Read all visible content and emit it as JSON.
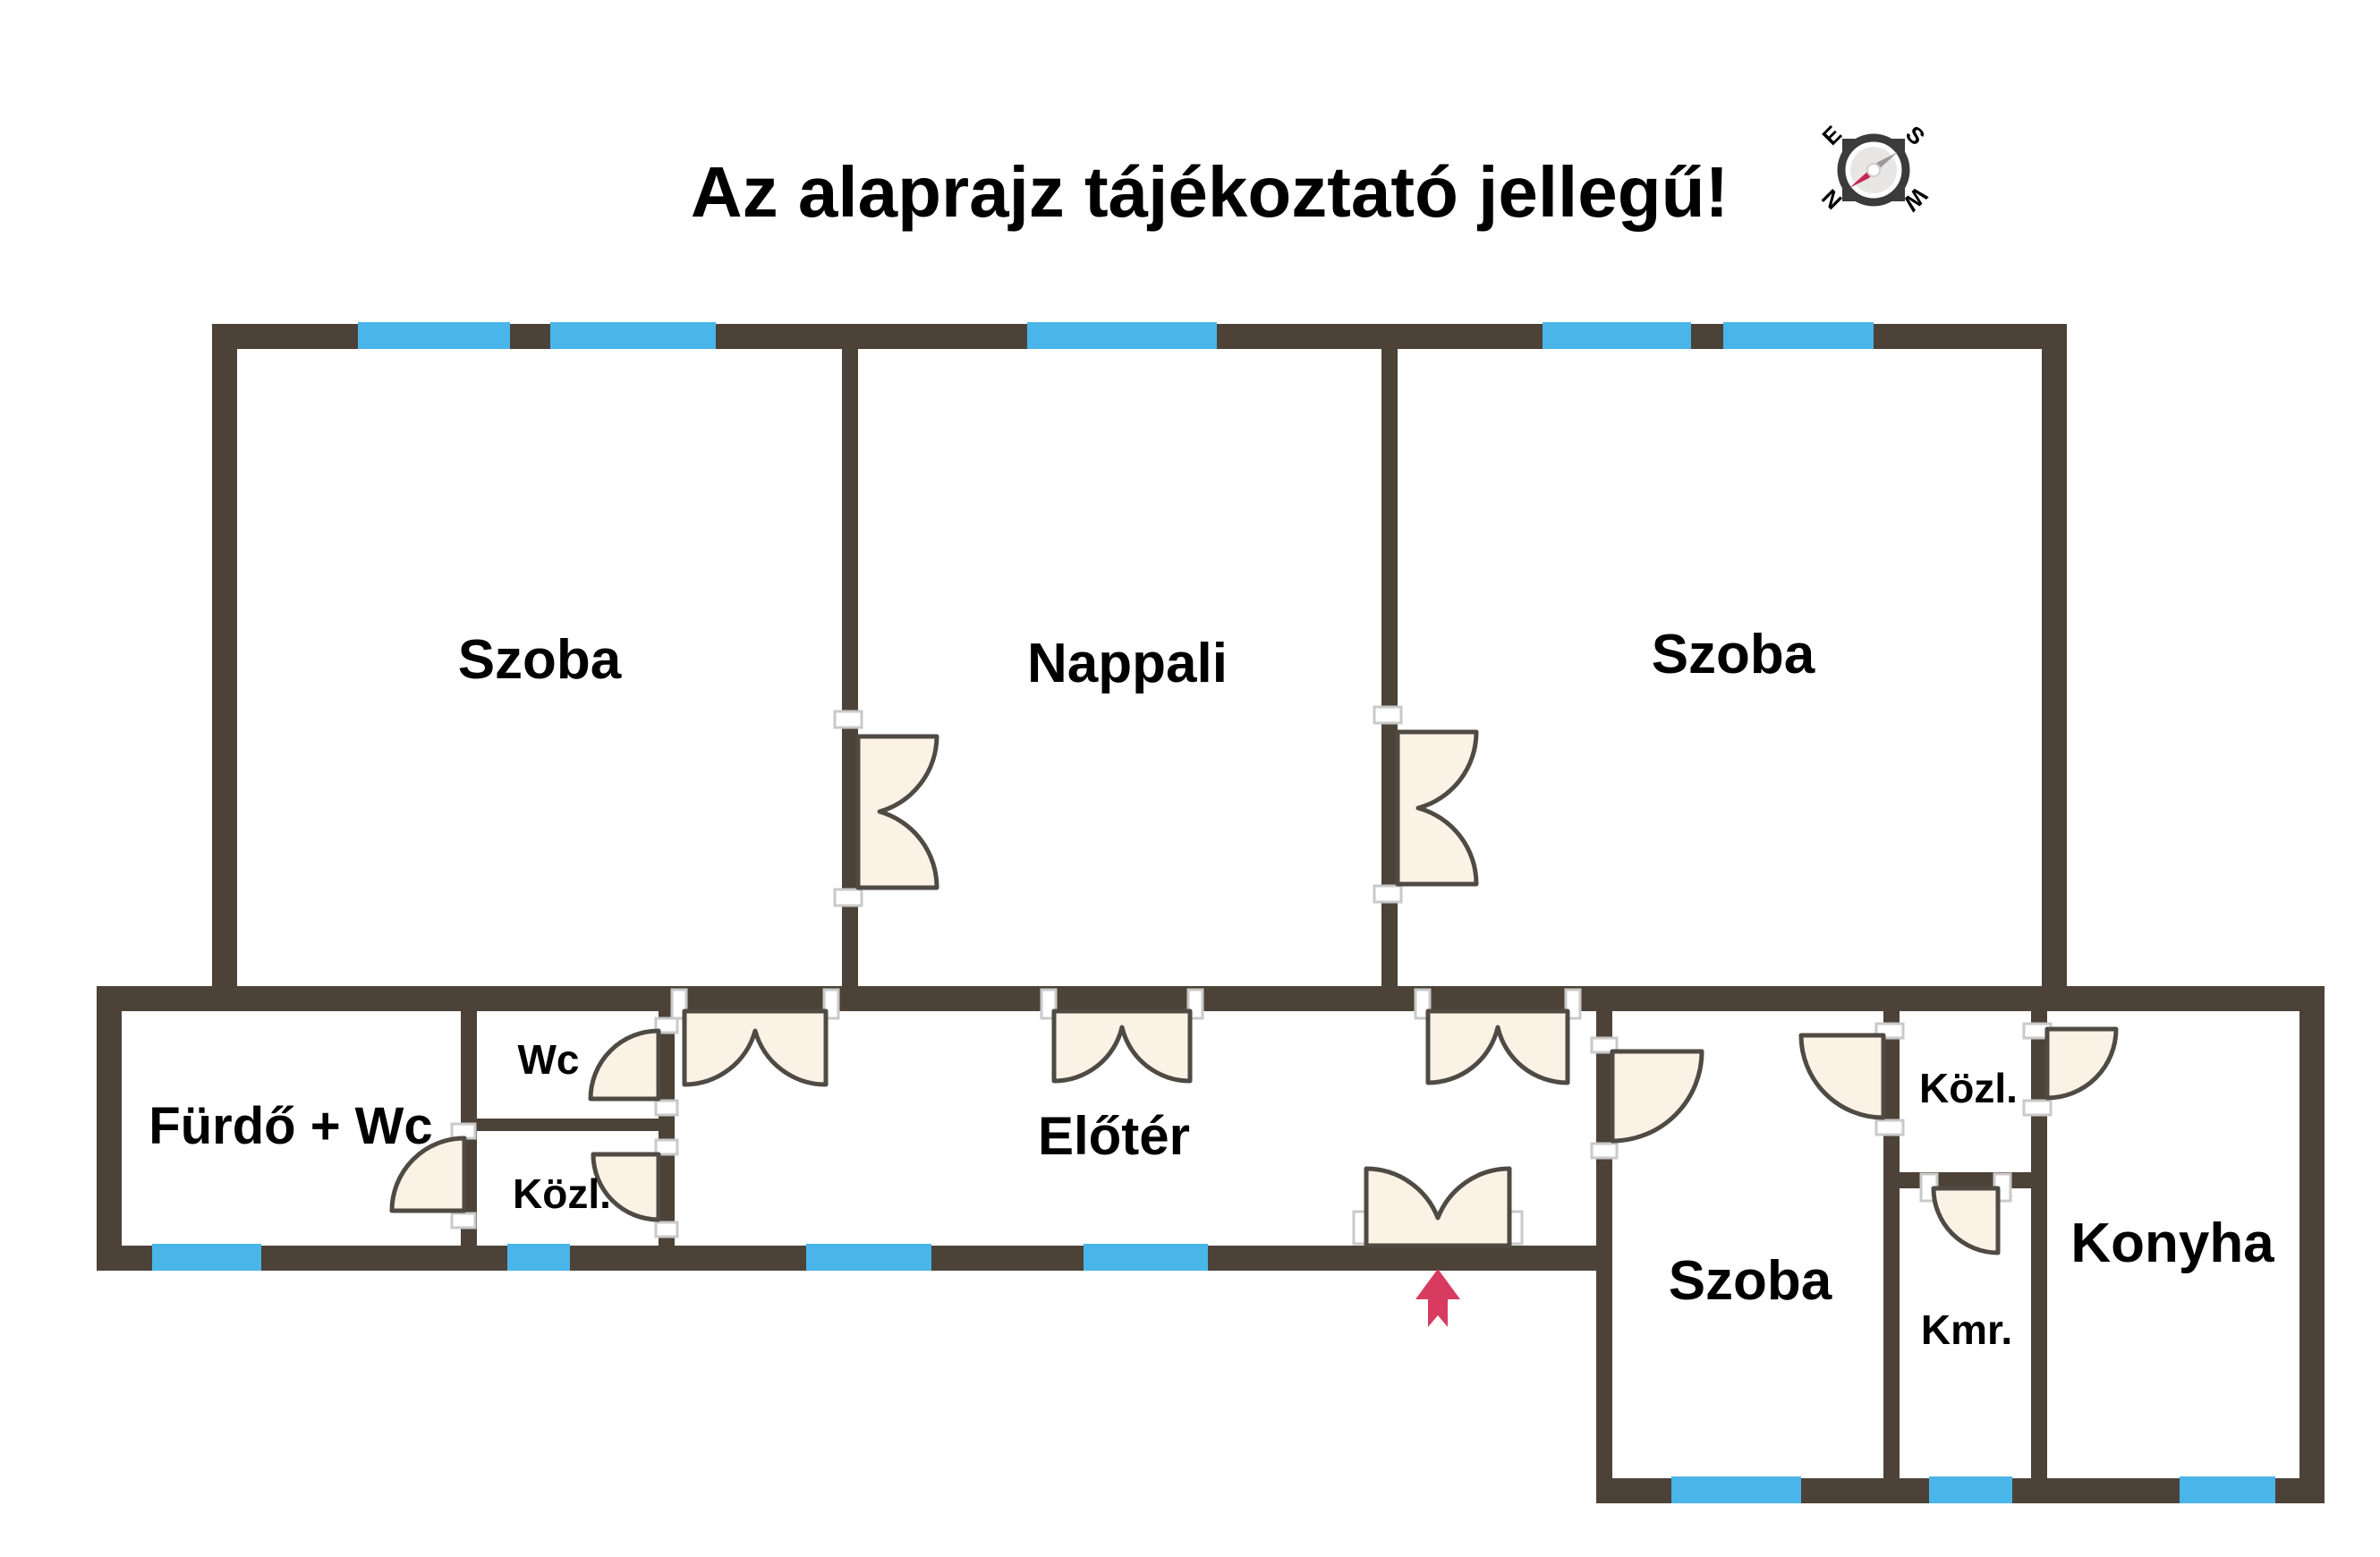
{
  "title": "Az alaprajz tájékoztató jellegű!",
  "compass": {
    "n": "N",
    "e": "E",
    "s": "S",
    "w": "W"
  },
  "rooms": {
    "szoba1": "Szoba",
    "nappali": "Nappali",
    "szoba2": "Szoba",
    "furdo": "Fürdő + Wc",
    "wc": "Wc",
    "kozl_left": "Közl.",
    "eloter": "Előtér",
    "szoba3": "Szoba",
    "kozl_right": "Közl.",
    "kmr": "Kmr.",
    "konyha": "Konyha"
  },
  "colors": {
    "wall": "#4c4238",
    "window": "#49b5e8",
    "door_fill": "#fbf2e6",
    "door_stroke": "#4f4a44",
    "jamb_stroke": "#c9c9c9",
    "arrow": "#d83b5f",
    "label": "#000000",
    "compass_ring": "#3b3b3b",
    "compass_face": "#e8e6e5",
    "compass_letters": "#999999",
    "needle_gray": "#9a9a9a",
    "needle_red": "#c92753"
  }
}
